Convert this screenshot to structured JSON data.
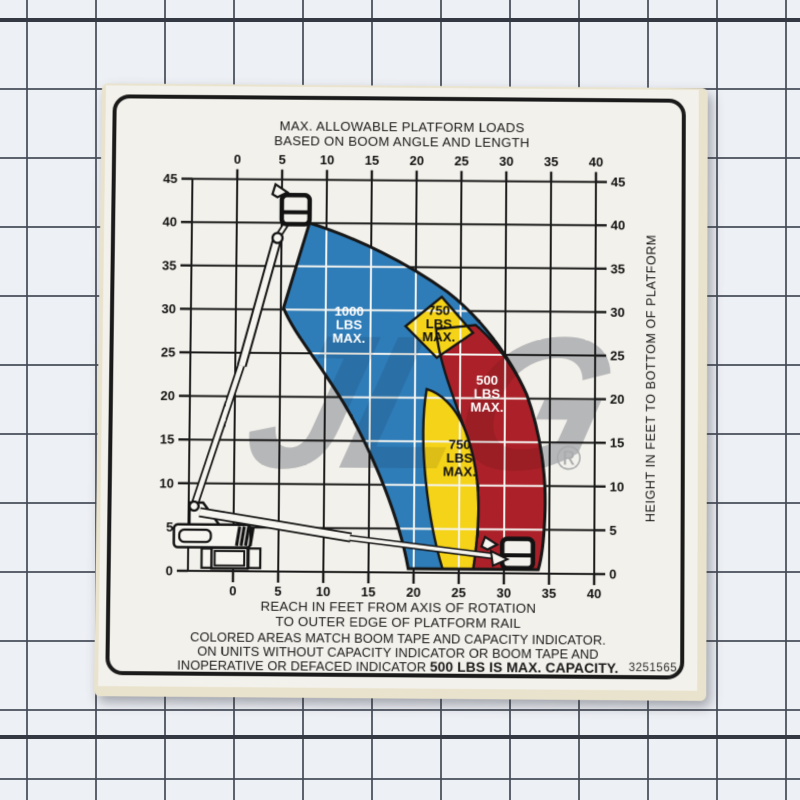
{
  "photo": {
    "mat_background": "#edf0f5",
    "mat_line_color": "#444a55",
    "mat_thick_line_color": "#343842"
  },
  "watermark": {
    "text": "JLG",
    "registered_mark": "®",
    "color": "#b6b7b9"
  },
  "sticker": {
    "part_number": "3251565",
    "title_line1": "MAX. ALLOWABLE PLATFORM LOADS",
    "title_line2": "BASED ON BOOM ANGLE AND LENGTH",
    "xlabel_line1": "REACH IN FEET FROM AXIS OF ROTATION",
    "xlabel_line2": "TO OUTER EDGE OF PLATFORM RAIL",
    "caption_line1": "COLORED AREAS MATCH BOOM TAPE AND CAPACITY INDICATOR.",
    "caption_line2": "ON UNITS WITHOUT CAPACITY INDICATOR OR BOOM TAPE AND",
    "caption_line3_regular": "INOPERATIVE OR DEFACED INDICATOR ",
    "caption_line3_bold": "500 LBS IS MAX. CAPACITY.",
    "background": "#f3f1eb",
    "border_color": "#1a1a1a",
    "backing_color": "#e9e3cd"
  },
  "chart_data": {
    "type": "area",
    "title": "MAX. ALLOWABLE PLATFORM LOADS BASED ON BOOM ANGLE AND LENGTH",
    "xlabel": "REACH IN FEET FROM AXIS OF ROTATION TO OUTER EDGE OF PLATFORM RAIL",
    "ylabel": "HEIGHT IN FEET TO BOTTOM OF PLATFORM",
    "x_unit": "feet",
    "y_unit": "feet",
    "xlim": [
      -5,
      40
    ],
    "ylim": [
      0,
      45
    ],
    "x_ticks": [
      0,
      5,
      10,
      15,
      20,
      25,
      30,
      35,
      40
    ],
    "y_ticks": [
      0,
      5,
      10,
      15,
      20,
      25,
      30,
      35,
      40,
      45
    ],
    "grid": true,
    "zones": [
      {
        "name": "zone-1000",
        "label": "1000 LBS MAX.",
        "capacity_lbs": 1000,
        "fill": "#2e7cb8",
        "label_color": "#ffffff",
        "label_center": {
          "x": 12.6,
          "y": 27.8
        },
        "description": "inner blue zone, reach approx 5-23 ft"
      },
      {
        "name": "zone-750-upper",
        "label": "750 LBS MAX.",
        "capacity_lbs": 750,
        "fill": "#f5d318",
        "label_color": "#121212",
        "label_center": {
          "x": 22.6,
          "y": 28.0
        },
        "description": "yellow diamond at reach approx 19-26 ft, height 25-31 ft"
      },
      {
        "name": "zone-500",
        "label": "500 LBS MAX.",
        "capacity_lbs": 500,
        "fill": "#ac2129",
        "label_color": "#ffffff",
        "label_center": {
          "x": 28.0,
          "y": 20.0
        },
        "description": "outer red band, reach approx 24-34 ft"
      },
      {
        "name": "zone-750-lower",
        "label": "750 LBS MAX.",
        "capacity_lbs": 750,
        "fill": "#f5d318",
        "label_color": "#121212",
        "label_center": {
          "x": 25.0,
          "y": 12.6
        },
        "description": "yellow band between blue and red below height 21 ft"
      }
    ],
    "envelope": {
      "max_reach_ft": 34,
      "max_platform_height_ft": 43,
      "reach_at_ground_ft": [
        19,
        34
      ]
    }
  }
}
